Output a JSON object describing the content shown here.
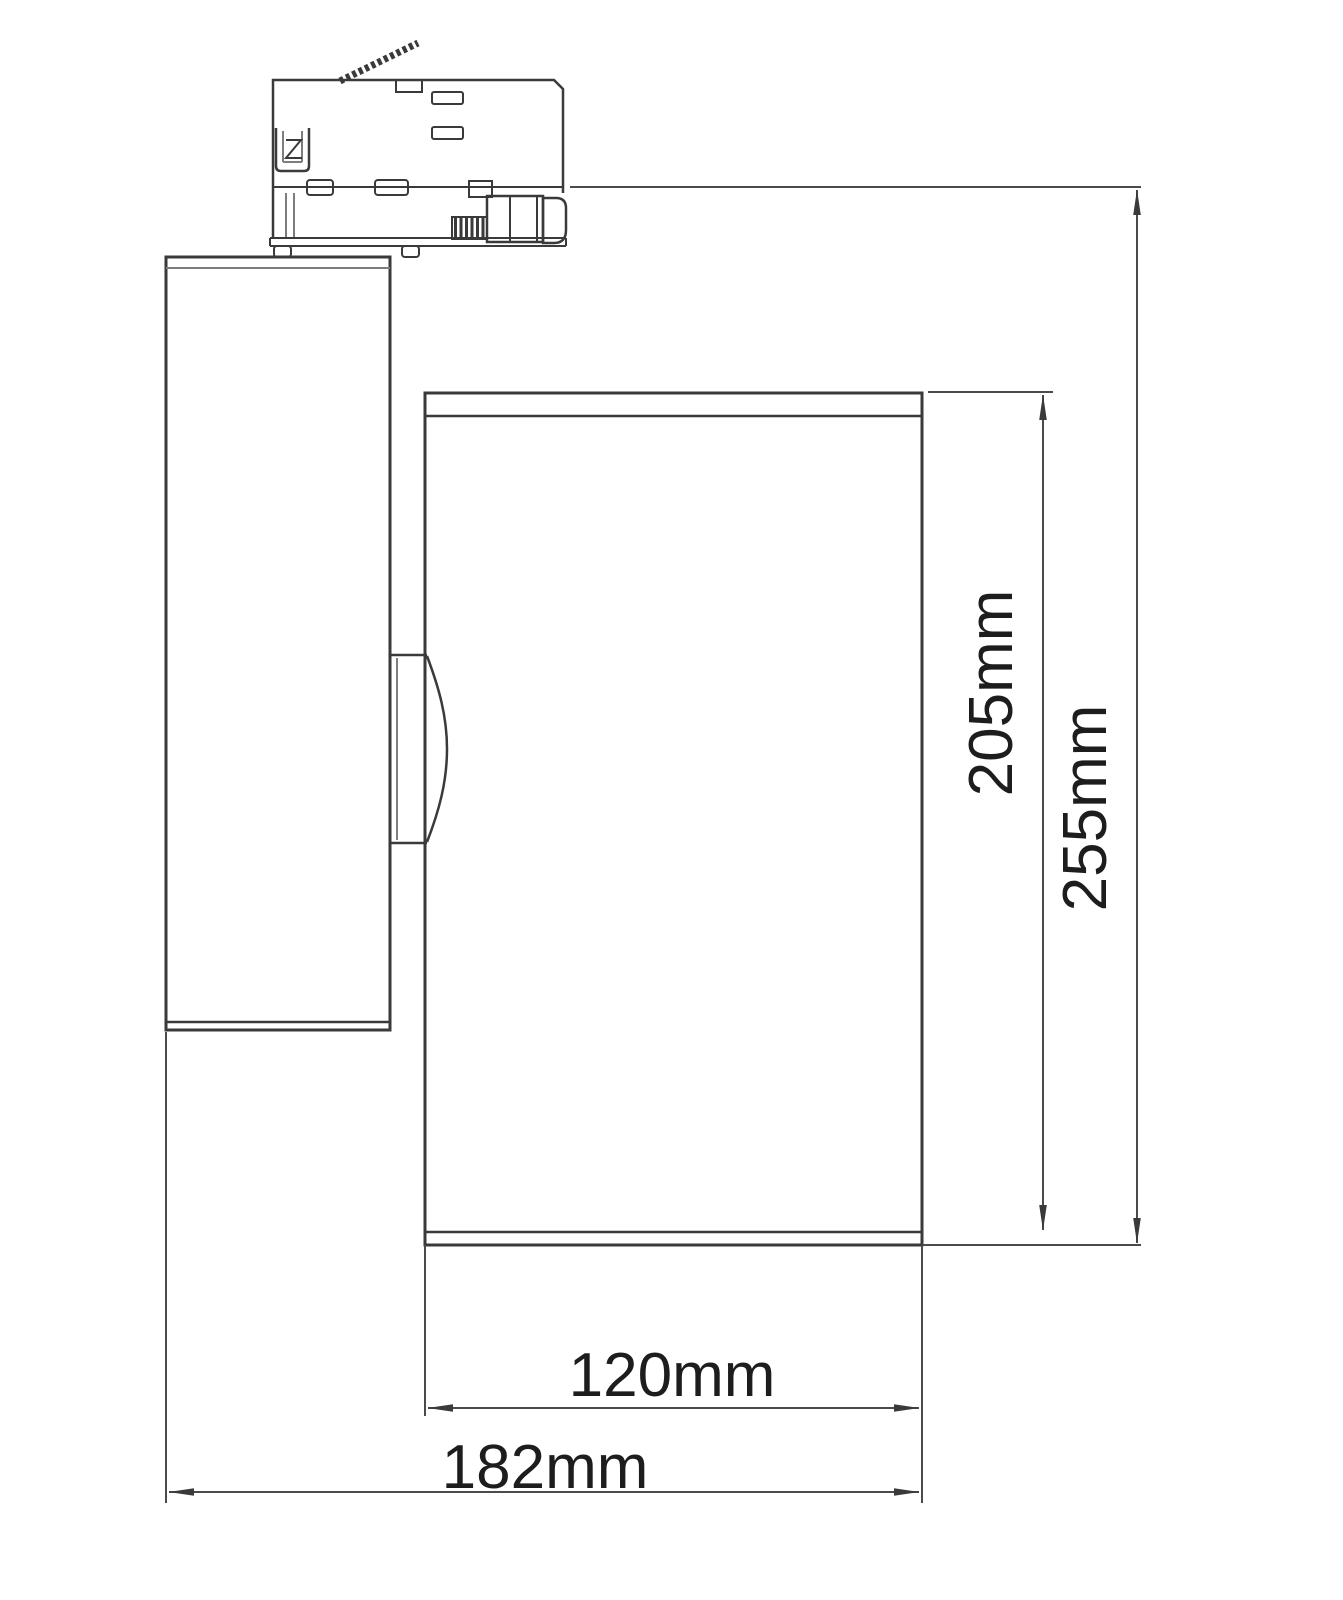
{
  "drawing": {
    "subject": "LED track spotlight side elevation with 3-phase track adapter",
    "view": "technical dimension drawing",
    "background_color": "#ffffff",
    "object_line_color": "#3a3a3a",
    "dimension_line_color": "#4b4b4b",
    "label_text_color": "#1d1d1d",
    "dimensions": {
      "head_width": "120mm",
      "overall_width": "182mm",
      "head_height": "205mm",
      "overall_height": "255mm"
    }
  }
}
